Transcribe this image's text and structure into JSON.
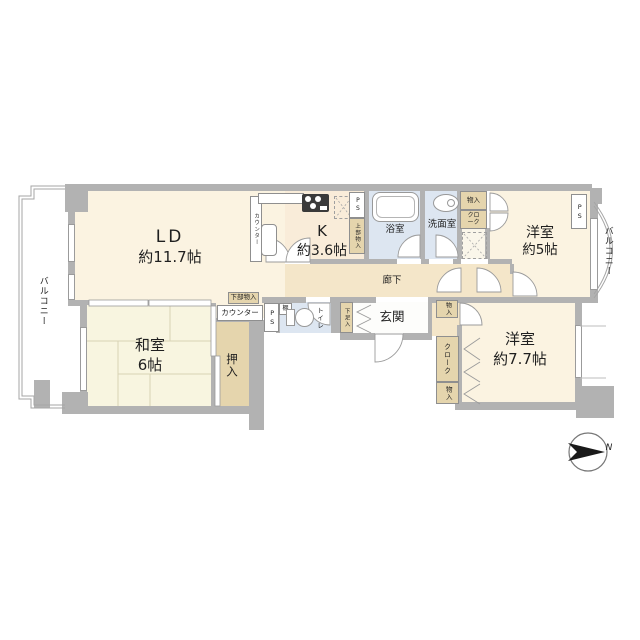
{
  "rooms": {
    "living_dining": {
      "name": "LD",
      "size": "約11.7帖"
    },
    "kitchen": {
      "name": "K",
      "size": "約3.6帖"
    },
    "bathroom": {
      "label": "浴室"
    },
    "washroom": {
      "label": "洗面室"
    },
    "western_room_5": {
      "name": "洋室",
      "size": "約5帖"
    },
    "hallway": {
      "label": "廊下"
    },
    "toilet": {
      "label": "トイレ"
    },
    "entrance": {
      "label": "玄関"
    },
    "japanese_room": {
      "name": "和室",
      "size": "6帖"
    },
    "oshiire": {
      "label": "押入"
    },
    "western_room_77": {
      "name": "洋室",
      "size": "約7.7帖"
    },
    "balcony_left": {
      "label": "バルコニー"
    },
    "balcony_right": {
      "label": "バルコニー"
    }
  },
  "fixtures": {
    "pipe_space": "PS",
    "upper_storage": "上部物入",
    "lower_storage": "下部物入",
    "counter": "カウンター",
    "storage": "物入",
    "cloak": "クローク",
    "shoe_storage": "下足入",
    "shelf": "棚"
  },
  "compass": {
    "north": "N"
  },
  "colors": {
    "wall": "#b2b2b2",
    "room_cream": "#fbf3e1",
    "kitchen_cream": "#f9ecd9",
    "tatami_room": "#f8f5e0",
    "wet_blue": "#dde6f1",
    "hall_beige": "#f4e6c9",
    "closet_tan": "#e5d5ad",
    "outline": "#9b9b9b"
  }
}
